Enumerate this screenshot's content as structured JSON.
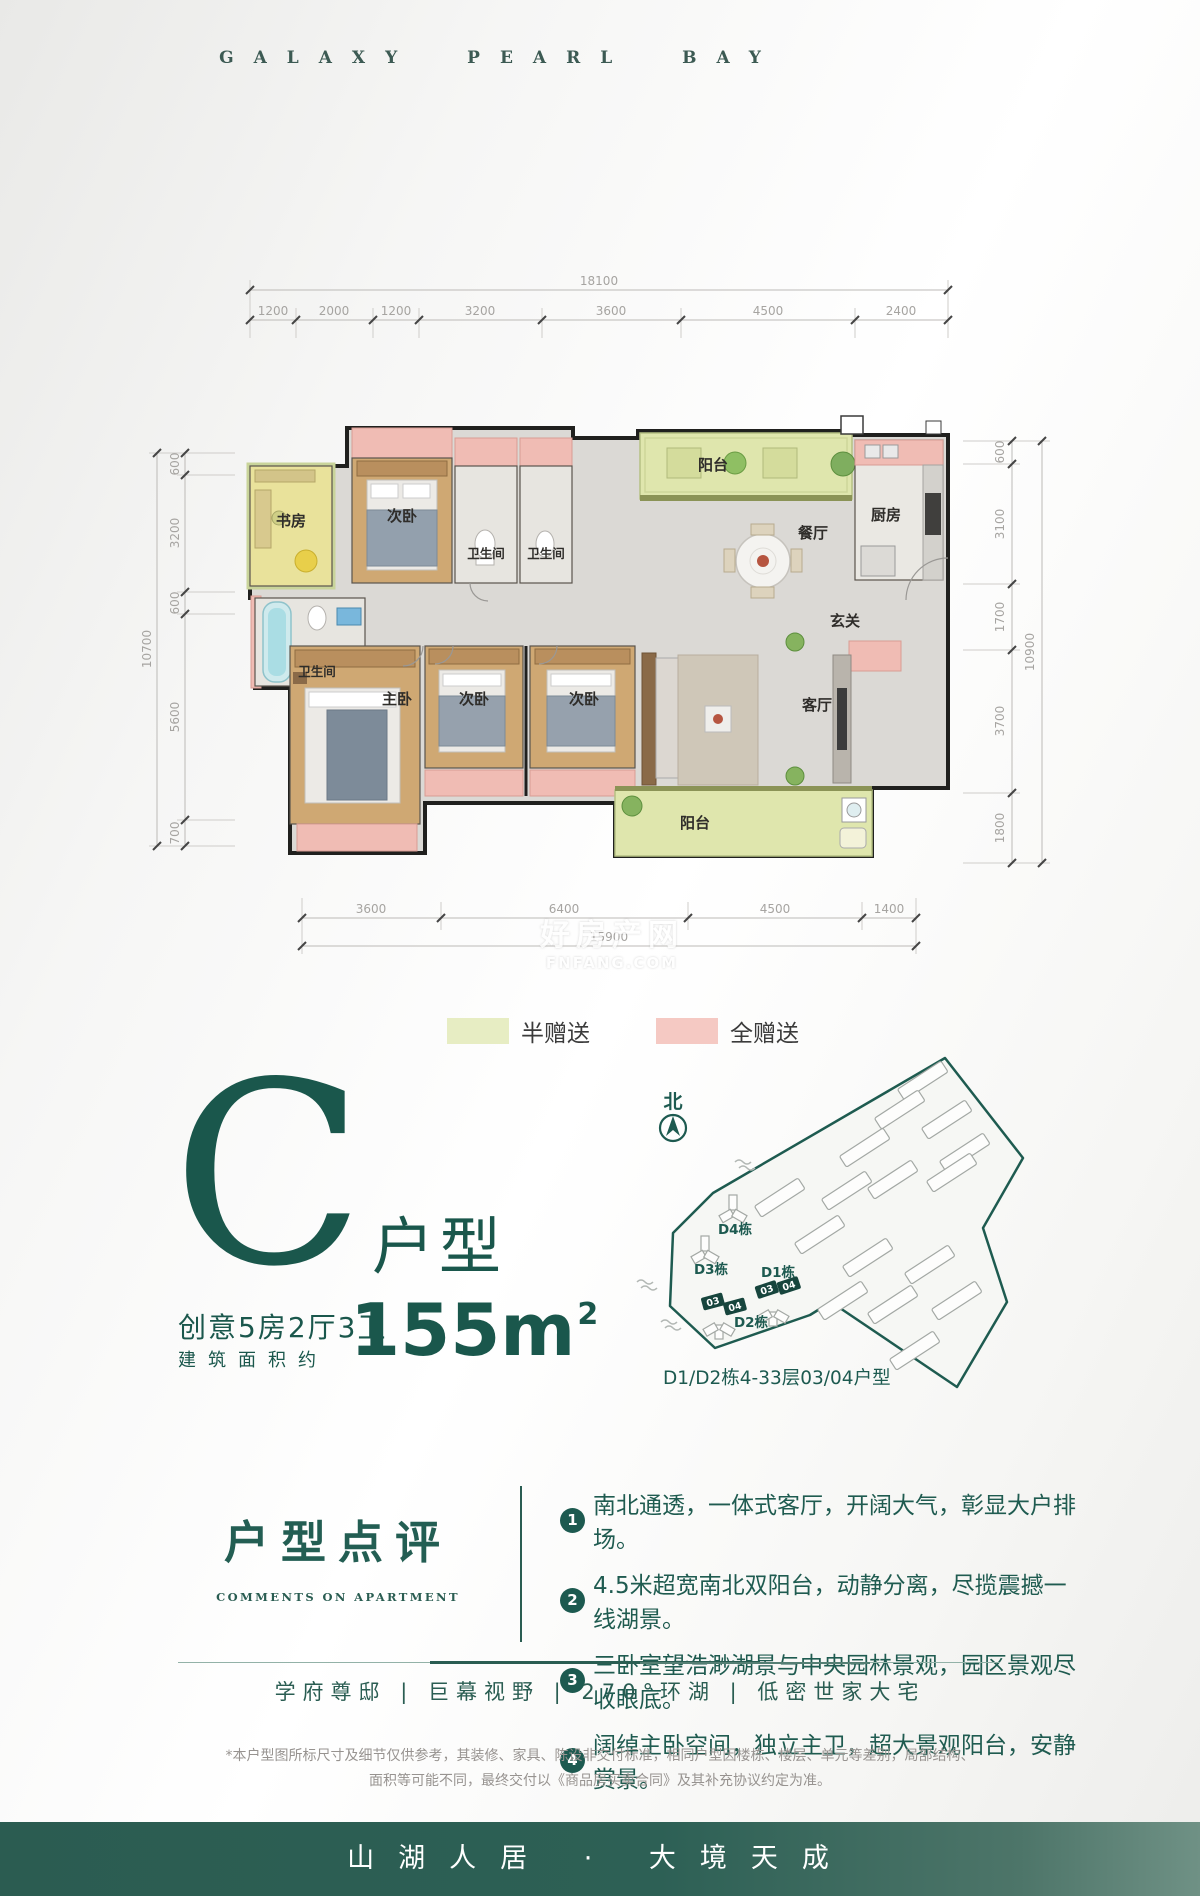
{
  "header": {
    "title": "GALAXY PEARL BAY"
  },
  "dims": {
    "top": {
      "total": "18100",
      "segments": [
        "1200",
        "2000",
        "1200",
        "3200",
        "3600",
        "4500",
        "2400"
      ]
    },
    "bottom": {
      "total": "15900",
      "segments": [
        "3600",
        "6400",
        "4500",
        "1400"
      ]
    },
    "left": {
      "total": "10700",
      "segments": [
        "600",
        "3200",
        "600",
        "5600",
        "700"
      ]
    },
    "right": {
      "total": "10900",
      "segments": [
        "600",
        "3100",
        "1700",
        "3700",
        "1800"
      ]
    }
  },
  "floorplan": {
    "labels": {
      "study": "书房",
      "bedroom": "次卧",
      "bath": "卫生间",
      "balcony": "阳台",
      "dining": "餐厅",
      "kitchen": "厨房",
      "foyer": "玄关",
      "master": "主卧",
      "living": "客厅"
    },
    "zone_colors": {
      "half_gift": "#dfe6ad",
      "full_gift": "#f0bcb4",
      "wood": "#cfa873",
      "wall": "#20201e"
    }
  },
  "watermark": {
    "line1": "好房产网",
    "line2": "FNFANG.COM"
  },
  "legend": {
    "half_label": "半赠送",
    "half_color": "#e7edc3",
    "full_label": "全赠送",
    "full_color": "#f5c9c3"
  },
  "unit": {
    "letter": "C",
    "suffix": "户型",
    "desc": "创意5房2厅3卫",
    "area_label": "建筑面积约",
    "area_value": "155m",
    "area_sup": "2"
  },
  "sitemap": {
    "north_label": "北",
    "blocks": [
      {
        "label": "D4栋"
      },
      {
        "label": "D3栋"
      },
      {
        "label": "D1栋"
      },
      {
        "label": "D2栋"
      }
    ],
    "badge_03": "03",
    "badge_04": "04",
    "caption": "D1/D2栋4-33层03/04户型",
    "outline_color": "#1d5a50"
  },
  "comments": {
    "title": "户型点评",
    "subtitle": "COMMENTS ON APARTMENT",
    "items": [
      {
        "num": "1",
        "text": "南北通透，一体式客厅，开阔大气，彰显大户排场。"
      },
      {
        "num": "2",
        "text": "4.5米超宽南北双阳台，动静分离，尽揽震撼一线湖景。"
      },
      {
        "num": "3",
        "text": "三卧室望浩渺湖景与中央园林景观，园区景观尽收眼底。"
      },
      {
        "num": "4",
        "text": "阔绰主卧空间，独立主卫，超大景观阳台，安静赏景。"
      }
    ]
  },
  "tagline": {
    "text": "学府尊邸 | 巨幕视野 | 270°环湖 | 低密世家大宅"
  },
  "disclaimer": {
    "line1": "*本户型图所标尺寸及细节仅供参考，其装修、家具、陈设非交付标准，相同户型因楼栋、楼层、单元等差别，局部结构、",
    "line2": "面积等可能不同，最终交付以《商品房买卖合同》及其补充协议约定为准。"
  },
  "footer": {
    "slogan": "山湖人居 · 大境天成",
    "bar_color": "#2c5f54"
  }
}
